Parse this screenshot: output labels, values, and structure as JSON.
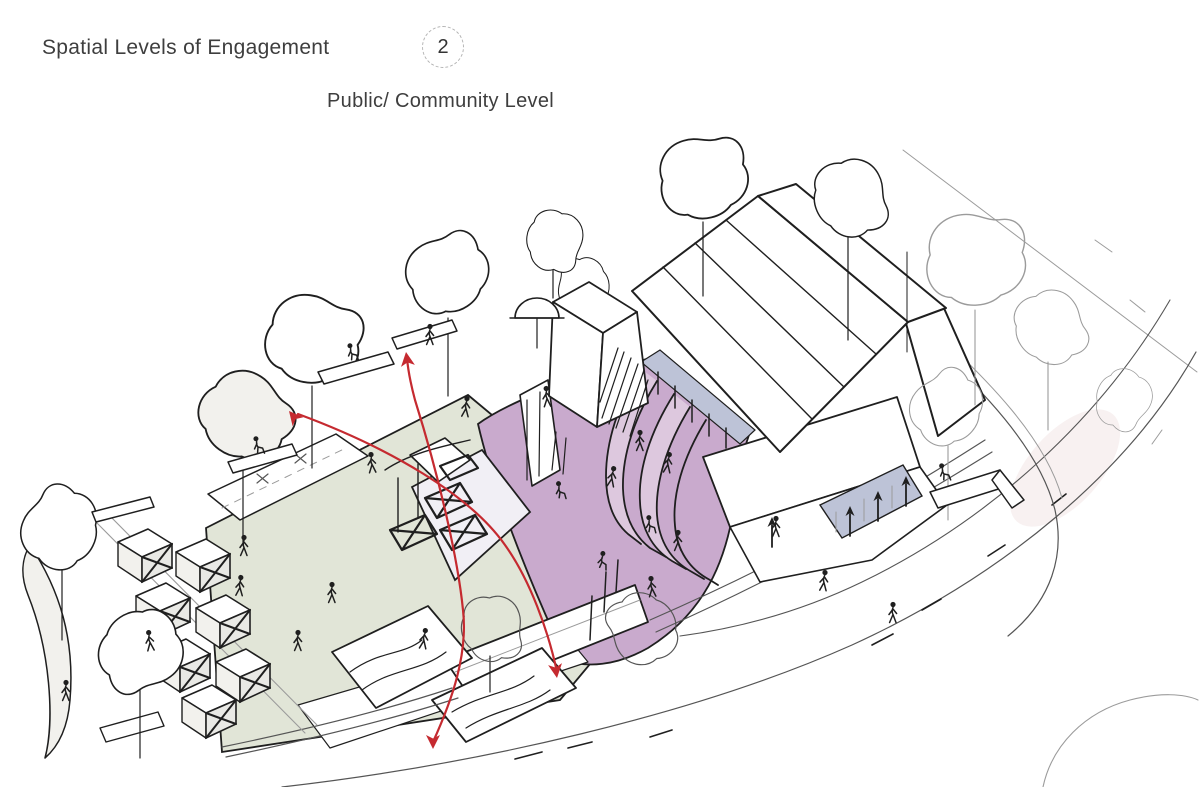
{
  "header": {
    "title": "Spatial Levels of Engagement",
    "badge_number": "2",
    "subtitle": "Public/ Community Level"
  },
  "colors": {
    "text": "#3e3e3e",
    "badge_border": "#b3b3b3",
    "ink": "#1f1f1f",
    "faint_ink": "#9b9b9b",
    "accent_red": "#c52a30",
    "plaza_sage": "#e1e5d7",
    "amphitheater_purple": "#c9aacd",
    "step_band_light": "#ddc8de",
    "glazing_blue": "#bdc3d7",
    "stall_gray": "#e9e9e5",
    "canopy_lavender": "#f1eff5",
    "wash_pink": "#f3e6e5"
  }
}
